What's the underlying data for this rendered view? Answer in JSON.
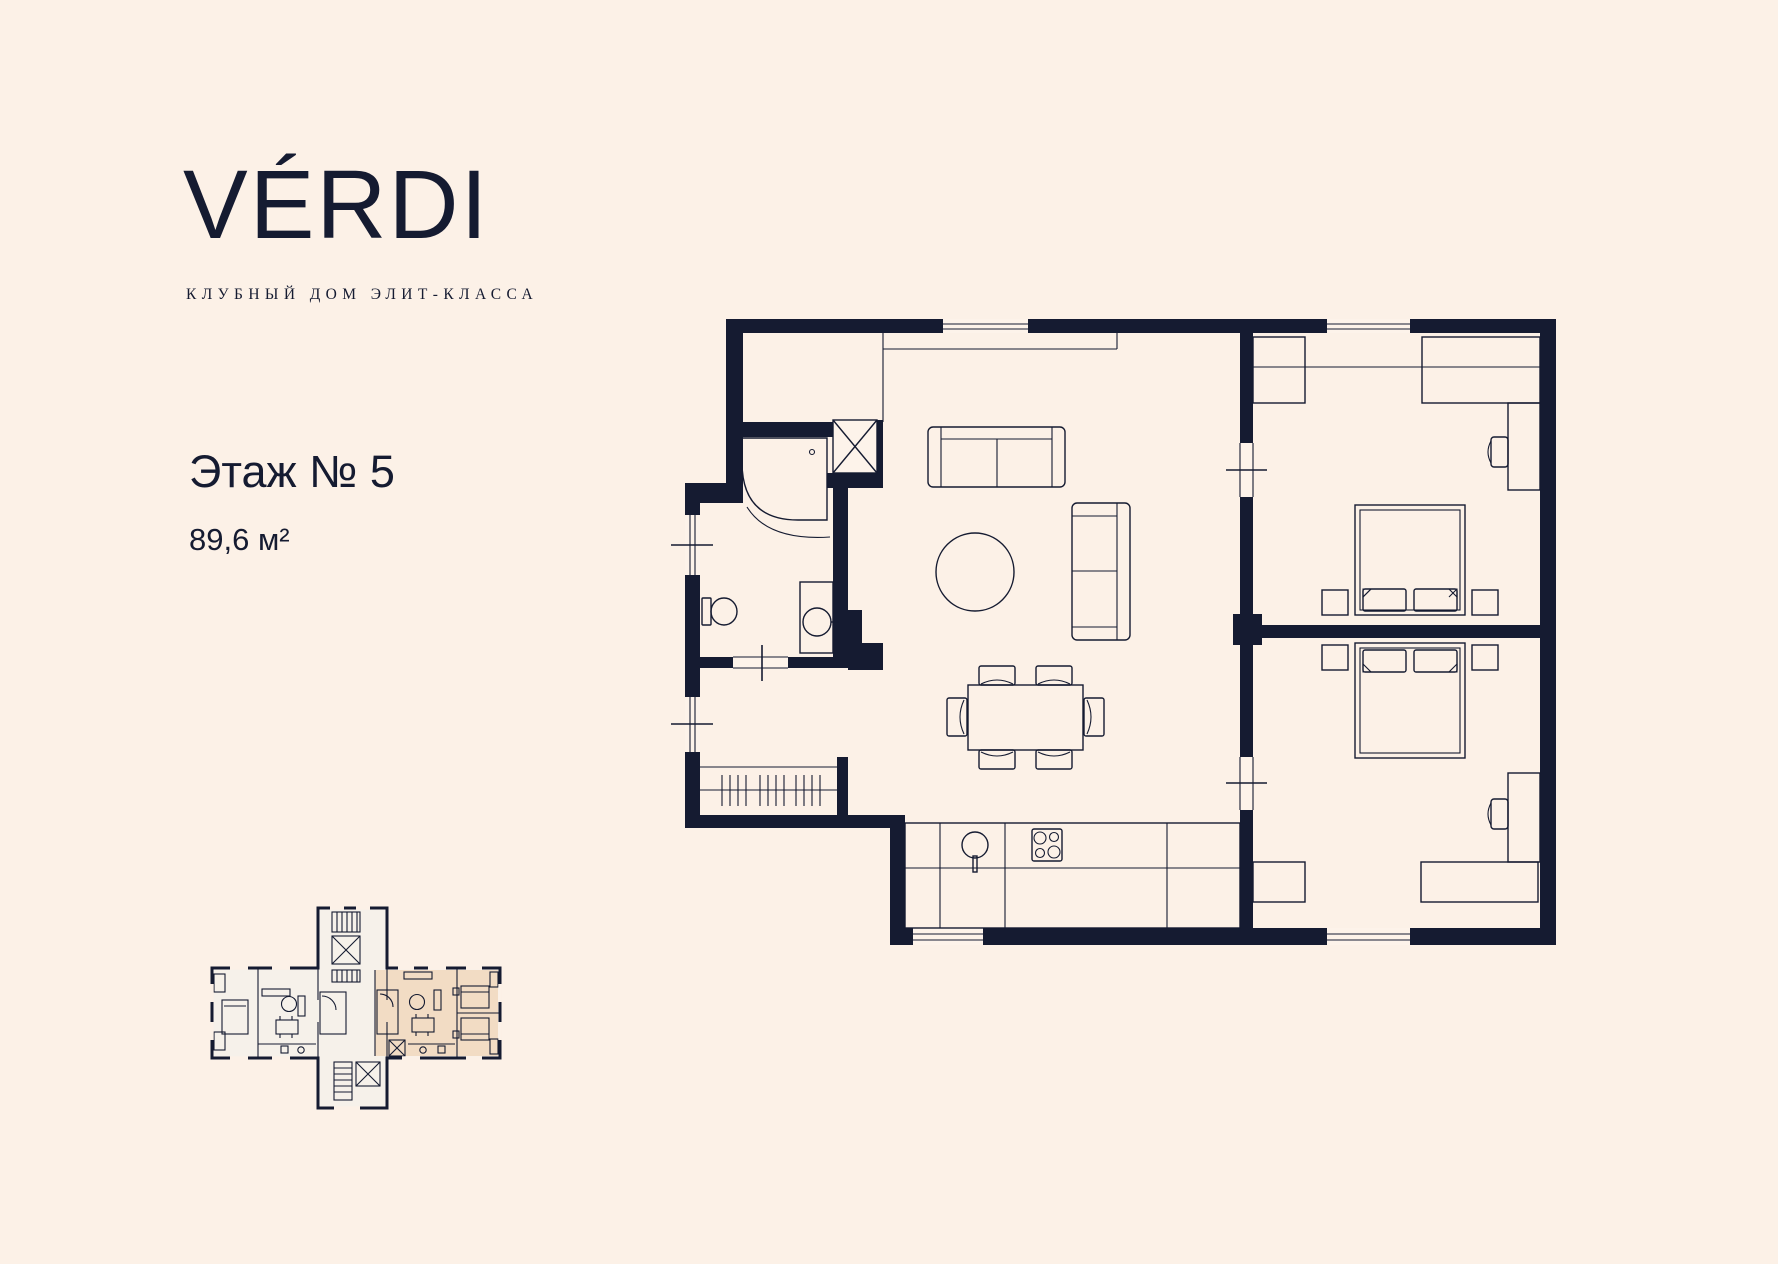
{
  "brand": {
    "logo": "VÉRDI",
    "tagline": "КЛУБНЫЙ ДОМ ЭЛИТ-КЛАССА"
  },
  "unit": {
    "floor_label": "Этаж № 5",
    "area_label": "89,6 м²"
  },
  "colors": {
    "background": "#fcf1e7",
    "ink": "#151b31",
    "plan_floor": "#fdf3ea",
    "highlight_unit": "#f2dcc4",
    "mini_room": "#f6f1ea"
  }
}
